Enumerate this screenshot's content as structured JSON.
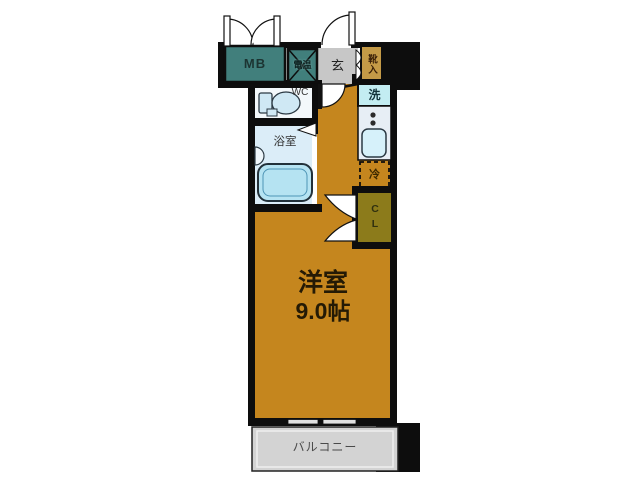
{
  "floorplan": {
    "type": "apartment-floor-plan",
    "rooms": {
      "meter_box": {
        "label": "MB"
      },
      "water_heater": {
        "label": "電温"
      },
      "entrance": {
        "label": "玄"
      },
      "shoe_cabinet": {
        "label": "靴入"
      },
      "wc": {
        "label": "WC"
      },
      "bathroom": {
        "label": "浴室"
      },
      "washer": {
        "label": "洗"
      },
      "fridge": {
        "label": "冷"
      },
      "closet": {
        "label": "CL"
      },
      "main_room": {
        "label": "洋室",
        "size": "9.0帖"
      },
      "balcony": {
        "label": "バルコニー"
      }
    },
    "colors": {
      "wall": "#0d0d0d",
      "room_orange": "#c5861e",
      "utility_teal": "#417f7c",
      "entrance_gray": "#c7c7c7",
      "shoe_tan": "#c49a47",
      "closet_olive": "#8c7b1b",
      "washer_cyan": "#c3edf2",
      "counter_gray": "#e7eef5",
      "fixture_blue": "#bde6f4",
      "bathroom_blue": "#dbedf8",
      "balcony_gray": "#d3d3d3"
    }
  }
}
